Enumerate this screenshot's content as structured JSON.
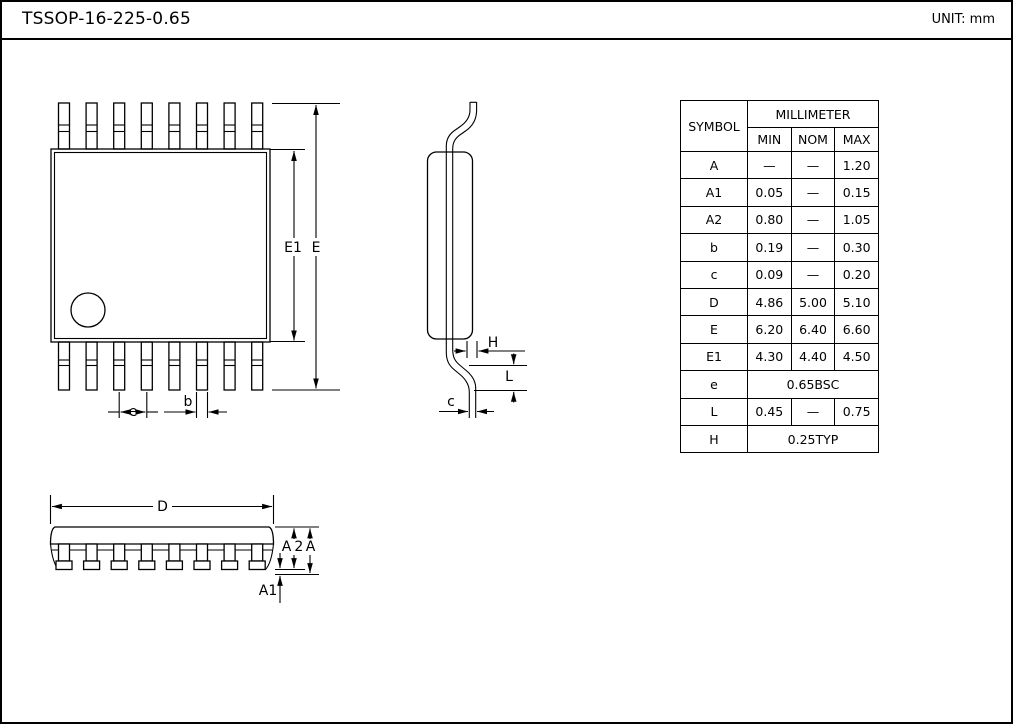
{
  "page": {
    "title": "TSSOP-16-225-0.65",
    "unit_label": "UNIT: mm"
  },
  "table": {
    "header": {
      "symbol": "SYMBOL",
      "group": "MILLIMETER",
      "min": "MIN",
      "nom": "NOM",
      "max": "MAX"
    },
    "rows": [
      {
        "sym": "A",
        "min": "—",
        "nom": "—",
        "max": "1.20"
      },
      {
        "sym": "A1",
        "min": "0.05",
        "nom": "—",
        "max": "0.15"
      },
      {
        "sym": "A2",
        "min": "0.80",
        "nom": "—",
        "max": "1.05"
      },
      {
        "sym": "b",
        "min": "0.19",
        "nom": "—",
        "max": "0.30"
      },
      {
        "sym": "c",
        "min": "0.09",
        "nom": "—",
        "max": "0.20"
      },
      {
        "sym": "D",
        "min": "4.86",
        "nom": "5.00",
        "max": "5.10"
      },
      {
        "sym": "E",
        "min": "6.20",
        "nom": "6.40",
        "max": "6.60"
      },
      {
        "sym": "E1",
        "min": "4.30",
        "nom": "4.40",
        "max": "4.50"
      },
      {
        "sym": "e",
        "span": "0.65BSC"
      },
      {
        "sym": "L",
        "min": "0.45",
        "nom": "—",
        "max": "0.75"
      },
      {
        "sym": "H",
        "span": "0.25TYP"
      }
    ]
  },
  "labels": {
    "top_view": {
      "E1": "E1",
      "E": "E",
      "e": "e",
      "b": "b"
    },
    "side_view": {
      "H": "H",
      "L": "L",
      "c": "c"
    },
    "front_view": {
      "D": "D",
      "A2": "A2",
      "A": "A",
      "A1": "A1"
    }
  },
  "colors": {
    "line": "#000000",
    "background": "#ffffff"
  }
}
